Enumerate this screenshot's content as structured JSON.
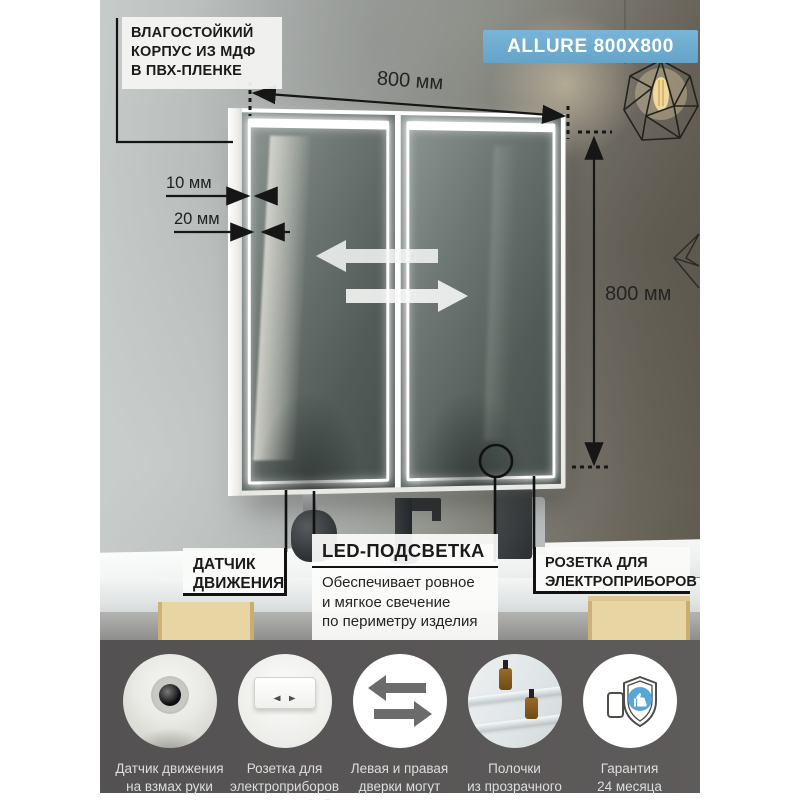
{
  "product": {
    "badge": "ALLURE 800X800"
  },
  "dimensions": {
    "width_label": "800 мм",
    "height_label": "800 мм",
    "edge_10": "10 мм",
    "edge_20": "20 мм"
  },
  "annotations": {
    "moisture": {
      "lines": [
        "ВЛАГОСТОЙКИЙ",
        "КОРПУС ИЗ МДФ",
        "В ПВХ-ПЛЕНКЕ"
      ]
    },
    "motion_sensor": {
      "lines": [
        "ДАТЧИК",
        "ДВИЖЕНИЯ"
      ]
    },
    "led": {
      "title": "LED-ПОДСВЕТКА",
      "desc_lines": [
        "Обеспечивает ровное",
        "и мягкое свечение",
        "по периметру изделия"
      ]
    },
    "socket": {
      "lines": [
        "РОЗЕТКА ДЛЯ",
        "ЭЛЕКТРОПРИБОРОВ"
      ]
    }
  },
  "features": [
    {
      "icon": "motion-sensor-icon",
      "lines": [
        "Датчик движения",
        "на взмах руки"
      ]
    },
    {
      "icon": "power-socket-icon",
      "lines": [
        "Розетка для",
        "электроприборов",
        "мощностью 2 кВт"
      ]
    },
    {
      "icon": "swap-doors-icon",
      "lines": [
        "Левая и правая",
        "дверки могут",
        "меняться местами"
      ]
    },
    {
      "icon": "glass-shelves-icon",
      "lines": [
        "Полочки",
        "из прозрачного",
        "стекла"
      ]
    },
    {
      "icon": "warranty-icon",
      "lines": [
        "Гарантия",
        "24 месяца"
      ]
    }
  ],
  "colors": {
    "badge_blue": "#6fadd3",
    "band_gray": "#595657",
    "accent_blue": "#57a8d9",
    "line_black": "#161616"
  }
}
